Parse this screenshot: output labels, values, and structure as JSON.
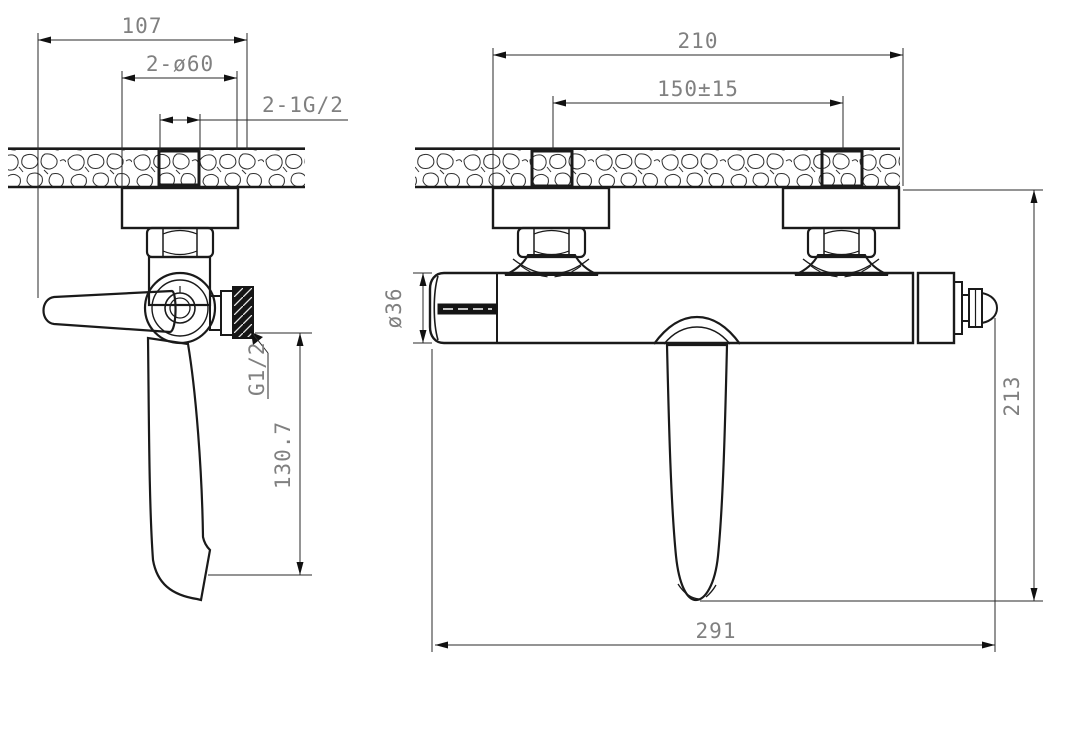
{
  "meta": {
    "background": "#ffffff",
    "line_color": "#1a1a1a",
    "dim_text_color": "#808080",
    "drawing_type": "bath-mixer-faucet-technical-drawing"
  },
  "side_view": {
    "dim_overall_width": "107",
    "dim_flange": "2-ø60",
    "dim_inlet_thread": "2-1G/2",
    "dim_outlet_thread": "G1/2",
    "dim_spout_height": "130.7"
  },
  "front_view": {
    "dim_overall_width": "210",
    "dim_inlet_spacing": "150±15",
    "dim_body_diameter": "ø36",
    "dim_height": "213",
    "dim_overall_length": "291"
  }
}
